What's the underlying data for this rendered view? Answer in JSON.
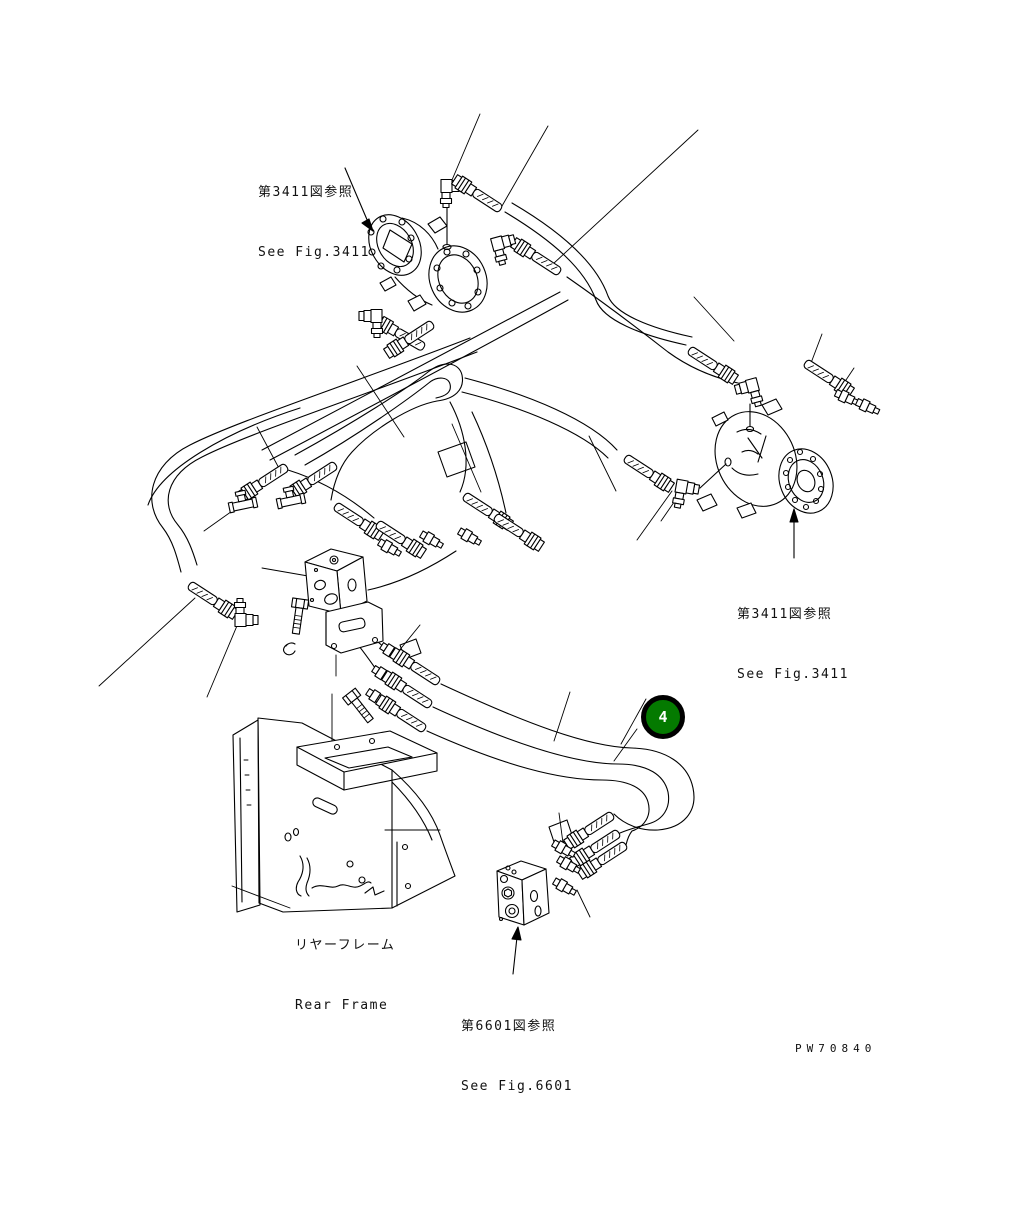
{
  "page": {
    "background": "#ffffff",
    "line_color": "#000000"
  },
  "labels": {
    "ref_fig_3411_top": {
      "line1": "第3411図参照",
      "line2": "See Fig.3411"
    },
    "ref_fig_3411_right": {
      "line1": "第3411図参照",
      "line2": "See Fig.3411"
    },
    "rear_frame": {
      "line1": "リヤーフレーム",
      "line2": "Rear Frame"
    },
    "ref_fig_6601_bottom": {
      "line1": "第6601図参照",
      "line2": "See Fig.6601"
    }
  },
  "callout": {
    "number": "4",
    "fill": "#047A00",
    "ring": "#000000",
    "text_color": "#ffffff"
  },
  "drawing_number": "PW70840"
}
